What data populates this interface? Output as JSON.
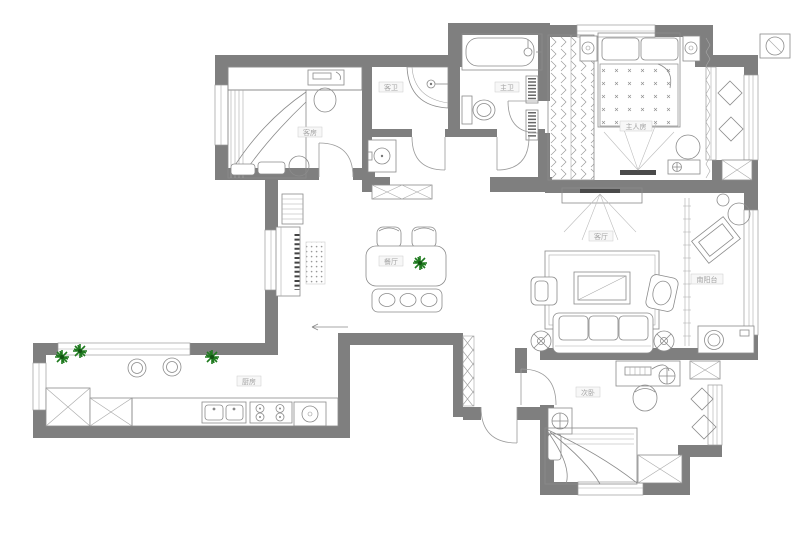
{
  "title": "residential-floor-plan",
  "colors": {
    "wall": "#7f7f7f",
    "line": "#8b8b8b",
    "accent_dark": "#4a4a4a",
    "plant_green": "#1e7a1e",
    "label_text": "#a3a3a3",
    "label_bg": "#f7f7f7",
    "label_border": "#cccccc",
    "paper": "#ffffff"
  },
  "rooms": [
    {
      "id": "guest-bedroom",
      "label": "客房"
    },
    {
      "id": "guest-bathroom",
      "label": "客卫"
    },
    {
      "id": "master-bathroom",
      "label": "主卫"
    },
    {
      "id": "master-bedroom",
      "label": "主人房"
    },
    {
      "id": "dining-room",
      "label": "餐厅"
    },
    {
      "id": "living-room",
      "label": "客厅"
    },
    {
      "id": "south-balcony",
      "label": "南阳台"
    },
    {
      "id": "kitchen",
      "label": "厨房"
    },
    {
      "id": "second-bedroom",
      "label": "次卧"
    }
  ],
  "furniture_icons": [
    "double-bed",
    "single-bed",
    "guest-bed",
    "nightstand",
    "table-lamp",
    "wardrobe",
    "corner-shower",
    "bathtub",
    "toilet",
    "wash-basin",
    "towel-radiator",
    "dining-table",
    "dining-chair",
    "dining-bench",
    "sideboard",
    "piano",
    "shoe-cabinet",
    "dot-rug",
    "sofa",
    "coffee-table",
    "armchair",
    "floor-lamp",
    "tv",
    "area-rug",
    "desk",
    "desk-chair",
    "washing-machine",
    "kitchen-counter",
    "kitchen-sink",
    "gas-stove",
    "refrigerator",
    "kitchen-stool",
    "plant",
    "air-conditioner",
    "diamond-tile",
    "entry-door",
    "interior-door",
    "window",
    "curtain",
    "sliding-door",
    "outdoor-ac-unit"
  ]
}
